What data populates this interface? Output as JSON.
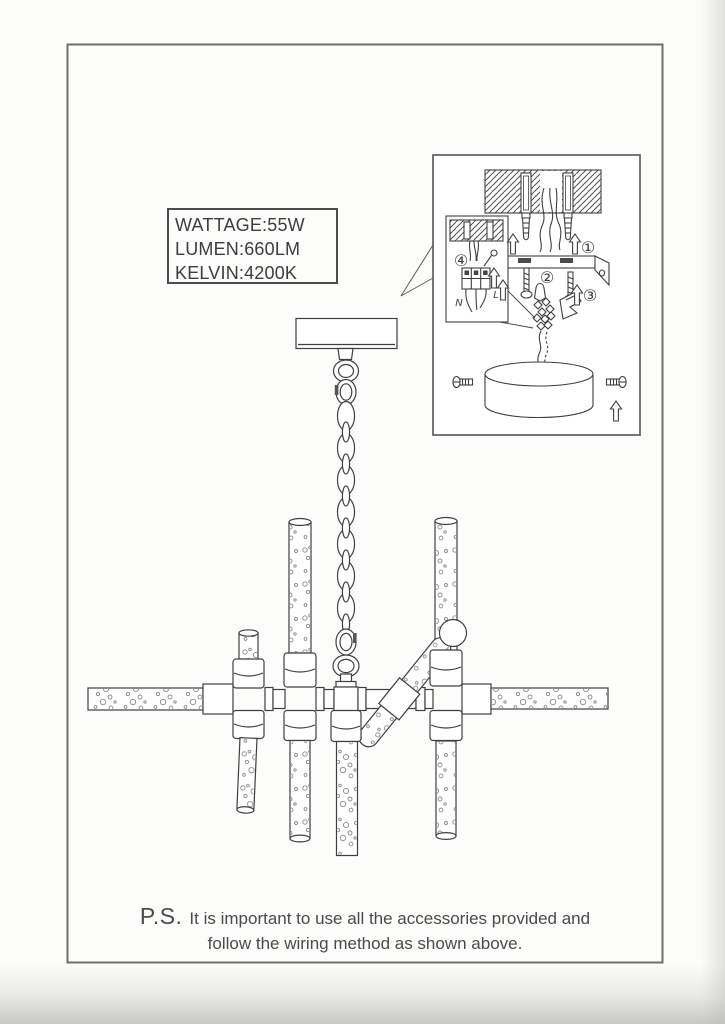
{
  "colors": {
    "ink": "#3f3f3f",
    "page_background": "#fcfcfb",
    "page_border": "#6e6e6e"
  },
  "spec_box": {
    "lines": [
      "WATTAGE:55W",
      "LUMEN:660LM",
      "KELVIN:4200K"
    ]
  },
  "wiring_inset": {
    "step_labels": [
      "①",
      "②",
      "③",
      "④"
    ],
    "neutral_label": "N",
    "live_label": "L"
  },
  "footnote": {
    "ps_label": "P.S.",
    "line1": "It is important to use all the accessories provided and",
    "line2": "follow the wiring method as shown above."
  }
}
